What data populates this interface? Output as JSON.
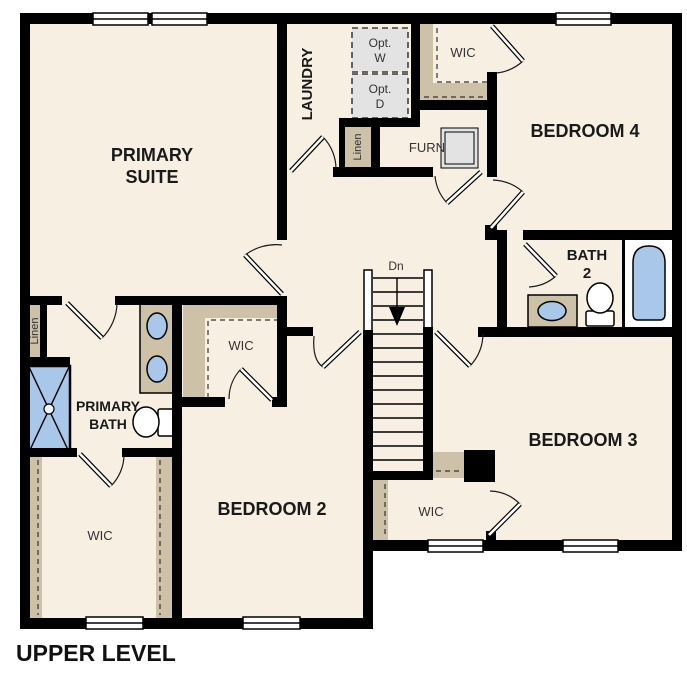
{
  "title": "UPPER LEVEL",
  "colors": {
    "floor": "#f7efe2",
    "closet_tan": "#cdc1a8",
    "fixture_blue": "#a9c7e8",
    "appliance_gray": "#e3e3e3",
    "wall": "#000000",
    "background": "#ffffff"
  },
  "rooms": {
    "primary_suite": {
      "label_line1": "PRIMARY",
      "label_line2": "SUITE"
    },
    "laundry": {
      "label": "LAUNDRY"
    },
    "bedroom4": {
      "label": "BEDROOM 4"
    },
    "bath2": {
      "label_line1": "BATH",
      "label_line2": "2"
    },
    "bedroom3": {
      "label": "BEDROOM 3"
    },
    "bedroom2": {
      "label": "BEDROOM 2"
    },
    "primary_bath": {
      "label_line1": "PRIMARY",
      "label_line2": "BATH"
    },
    "wic_bedroom4": {
      "label": "WIC"
    },
    "wic_primary": {
      "label": "WIC"
    },
    "wic_bedroom2": {
      "label": "WIC"
    },
    "wic_bedroom3": {
      "label": "WIC"
    },
    "linen_hall": {
      "label": "Linen"
    },
    "linen_primary": {
      "label": "Linen"
    },
    "furnace": {
      "label": "FURN"
    },
    "stairs": {
      "label": "Dn"
    },
    "opt_washer": {
      "line1": "Opt.",
      "line2": "W"
    },
    "opt_dryer": {
      "line1": "Opt.",
      "line2": "D"
    }
  }
}
